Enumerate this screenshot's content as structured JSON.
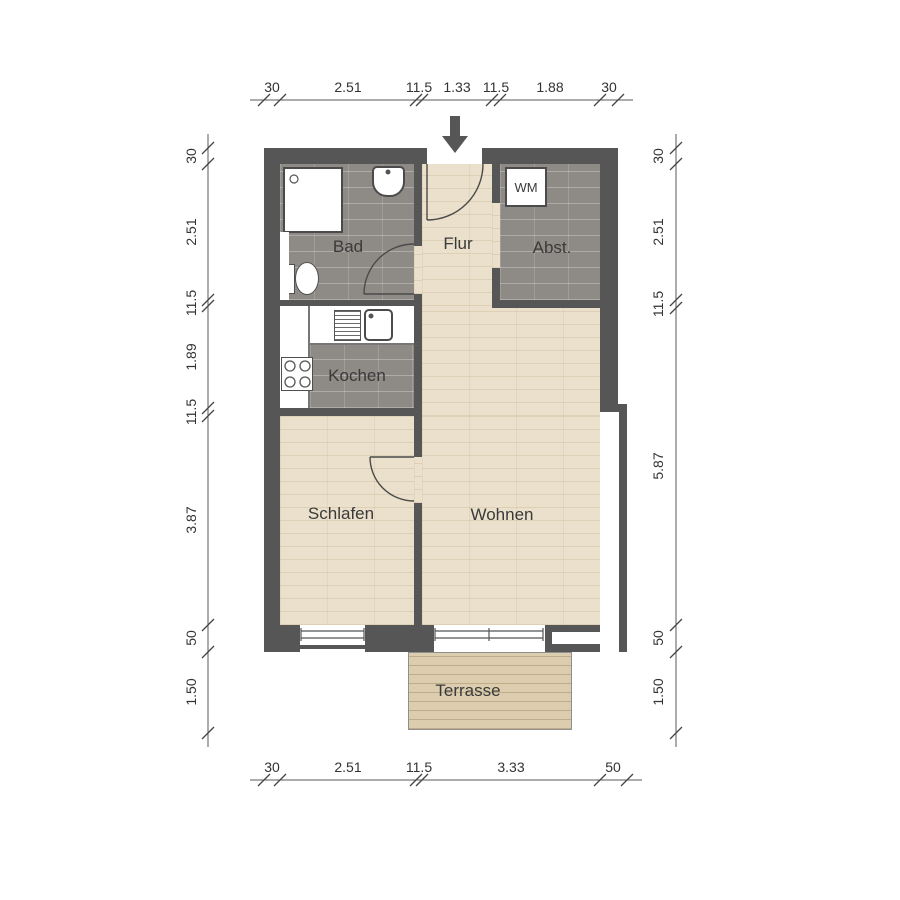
{
  "plan": {
    "rooms": {
      "bad": "Bad",
      "flur": "Flur",
      "abstellraum": "Abst.",
      "kochen": "Kochen",
      "schlafen": "Schlafen",
      "wohnen": "Wohnen",
      "terrasse": "Terrasse"
    },
    "fixtures": {
      "washing_machine": "WM"
    },
    "dimensions": {
      "top": [
        "30",
        "2.51",
        "11.5",
        "1.33",
        "11.5",
        "1.88",
        "30"
      ],
      "bottom": [
        "30",
        "2.51",
        "11.5",
        "3.33",
        "50"
      ],
      "left": [
        "30",
        "2.51",
        "11.5",
        "1.89",
        "11.5",
        "3.87",
        "50",
        "1.50"
      ],
      "right": [
        "30",
        "2.51",
        "11.5",
        "5.87",
        "50",
        "1.50"
      ]
    },
    "colors": {
      "wall": "#575656",
      "tile_floor": "#8e8a86",
      "wood_floor": "#ebe0cb",
      "terrace": "#dccdae",
      "background": "#ffffff",
      "label": "#3a3a3a"
    }
  }
}
